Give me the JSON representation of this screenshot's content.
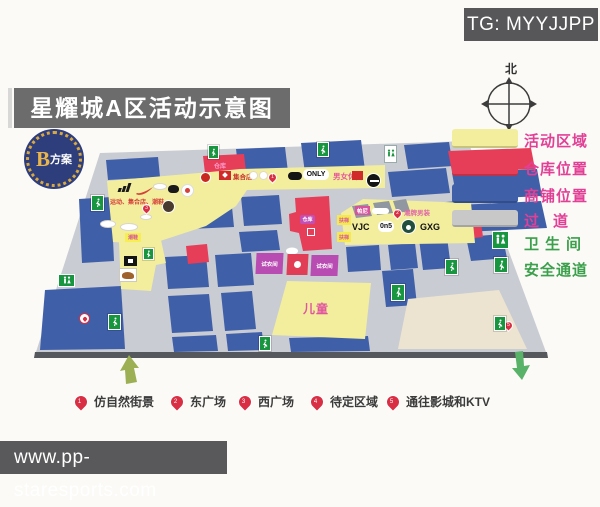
{
  "header": {
    "title": "星耀城A区活动示意图",
    "tg_badge": "TG: MYYJJPP",
    "plan_letter": "B",
    "plan_text": "方案"
  },
  "compass": {
    "north_label": "北"
  },
  "legend": {
    "activity": "活动区域",
    "warehouse": "仓库位置",
    "shops": "商铺位置",
    "aisle": "过道",
    "toilet": "卫生间",
    "safety": "安全通道"
  },
  "map": {
    "sports_zone_text": "运动、集合店、潮鞋",
    "shoes_tag": "潮鞋",
    "collection_store": "集合店",
    "only_label": "ONLY",
    "casual_label": "男女休闲",
    "warehouse_tag_top": "仓库",
    "warehouse_tag_center": "仓库",
    "pani_label": "帕尼",
    "menswear_label": "潮牌男装",
    "escalator_tag_1": "扶梯",
    "escalator_tag_2": "扶梯",
    "vjc": "VJC",
    "on5": "0n5",
    "gxg": "GXG",
    "fitting_room_1": "试衣间",
    "fitting_room_2": "试衣间",
    "kids_label": "儿童",
    "pins": [
      {
        "n": "1"
      },
      {
        "n": "2"
      },
      {
        "n": "3"
      },
      {
        "n": "4"
      },
      {
        "n": "5"
      }
    ]
  },
  "footer_legend": {
    "items": [
      {
        "pin": "1",
        "label": "仿自然街景"
      },
      {
        "pin": "2",
        "label": "东广场"
      },
      {
        "pin": "3",
        "label": "西广场"
      },
      {
        "pin": "4",
        "label": "待定区域"
      },
      {
        "pin": "5",
        "label": "通往影城和KTV"
      }
    ]
  },
  "footer": {
    "url": "www.pp-staresports.com"
  },
  "colors": {
    "activity_yellow": "#f2ee9d",
    "warehouse_red": "#e63d58",
    "shop_blue": "#3f5fa8",
    "aisle_gray": "#c9ccd2",
    "legend_pink": "#e23f96",
    "legend_green": "#3ba04b",
    "banner_gray": "#6c6c6c"
  }
}
